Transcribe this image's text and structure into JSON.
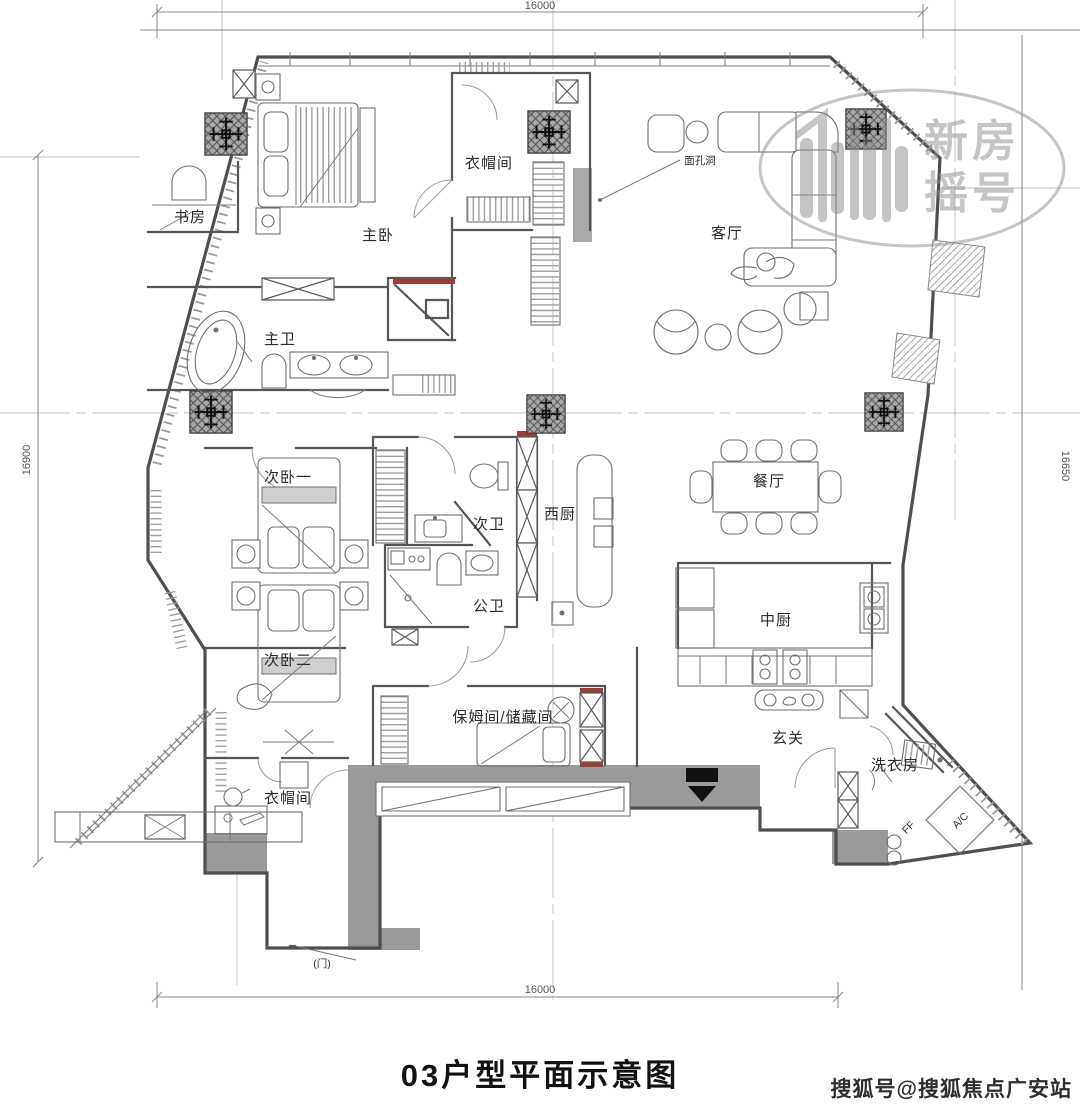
{
  "title": "03户型平面示意图",
  "footer_watermark": "搜狐号@搜狐焦点广安站",
  "logo_watermark": {
    "line1": "新房",
    "line2": "摇号"
  },
  "dimensions": {
    "top": "16000",
    "bottom": "16000",
    "left": "16900",
    "right": "16650"
  },
  "rooms": [
    {
      "id": "study",
      "label": "书房"
    },
    {
      "id": "master-bedroom",
      "label": "主卧"
    },
    {
      "id": "master-closet",
      "label": "衣帽间"
    },
    {
      "id": "living-room",
      "label": "客厅"
    },
    {
      "id": "master-bath",
      "label": "主卫"
    },
    {
      "id": "bedroom-2",
      "label": "次卧一"
    },
    {
      "id": "bath-2",
      "label": "次卫"
    },
    {
      "id": "west-kitchen",
      "label": "西厨"
    },
    {
      "id": "dining-room",
      "label": "餐厅"
    },
    {
      "id": "bedroom-3",
      "label": "次卧二"
    },
    {
      "id": "public-bath",
      "label": "公卫"
    },
    {
      "id": "chinese-kitchen",
      "label": "中厨"
    },
    {
      "id": "maid-storage",
      "label": "保姆间/储藏间"
    },
    {
      "id": "foyer",
      "label": "玄关"
    },
    {
      "id": "laundry",
      "label": "洗衣房"
    },
    {
      "id": "entry-closet",
      "label": "衣帽间"
    }
  ],
  "annotations": {
    "hole_label": "面孔洞",
    "ac_unit": "A/C",
    "ff": "FF",
    "door_note": "(门)"
  },
  "colors": {
    "wall": "#4f4f4f",
    "gray_fill": "#9a9a9a",
    "accent_red": "#9e3a3a",
    "centerline": "#c3c3c3",
    "watermark_gray": "#8d8d8d"
  }
}
